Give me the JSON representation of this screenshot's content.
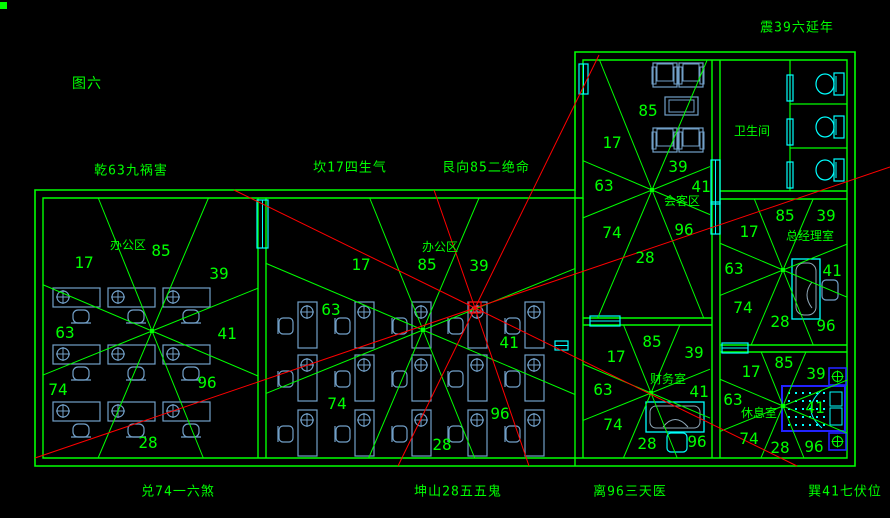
{
  "title": {
    "text": "图六"
  },
  "colors": {
    "background": "#000000",
    "wall_green": "#00ff00",
    "line_red": "#ff0000",
    "furniture_blue": "#72a0c8",
    "fixture_cyan": "#00ffff",
    "bed_blue": "#2222ff",
    "desk_inner_gray": "#8fa8b8"
  },
  "compass_labels": {
    "qian": "乾63九祸害",
    "kan": "坎17四生气",
    "gen": "艮向85二绝命",
    "zhen": "震39六延年",
    "dui": "兑74一六煞",
    "kun": "坤山28五五鬼",
    "li": "离96三天医",
    "xun": "巽41七伏位"
  },
  "rooms": {
    "office_left": {
      "label": "办公区",
      "numbers": {
        "nw": "17",
        "n": "85",
        "ne": "39",
        "w": "63",
        "e": "41",
        "sw": "74",
        "s": "28",
        "se": "96"
      }
    },
    "office_middle": {
      "label": "办公区",
      "numbers": {
        "nw": "17",
        "n": "85",
        "ne": "39",
        "w": "63",
        "e": "41",
        "sw": "74",
        "s": "28",
        "se": "96"
      }
    },
    "meeting": {
      "label": "会客区",
      "numbers": {
        "nw": "17",
        "n": "85",
        "ne": "39",
        "w": "63",
        "e": "41",
        "sw": "74",
        "s": "28",
        "se": "96"
      }
    },
    "manager": {
      "label": "总经理室",
      "numbers": {
        "nw": "17",
        "n": "85",
        "ne": "39",
        "w": "63",
        "e": "41",
        "sw": "74",
        "s": "28",
        "se": "96"
      }
    },
    "finance": {
      "label": "财务室",
      "numbers": {
        "nw": "17",
        "n": "85",
        "ne": "39",
        "w": "63",
        "e": "41",
        "sw": "74",
        "s": "28",
        "se": "96"
      }
    },
    "rest": {
      "label": "休息室",
      "numbers": {
        "nw": "17",
        "n": "85",
        "ne": "39",
        "w": "63",
        "e": "41",
        "sw": "74",
        "s": "28",
        "se": "96"
      }
    },
    "bathroom": {
      "label": "卫生间"
    }
  }
}
